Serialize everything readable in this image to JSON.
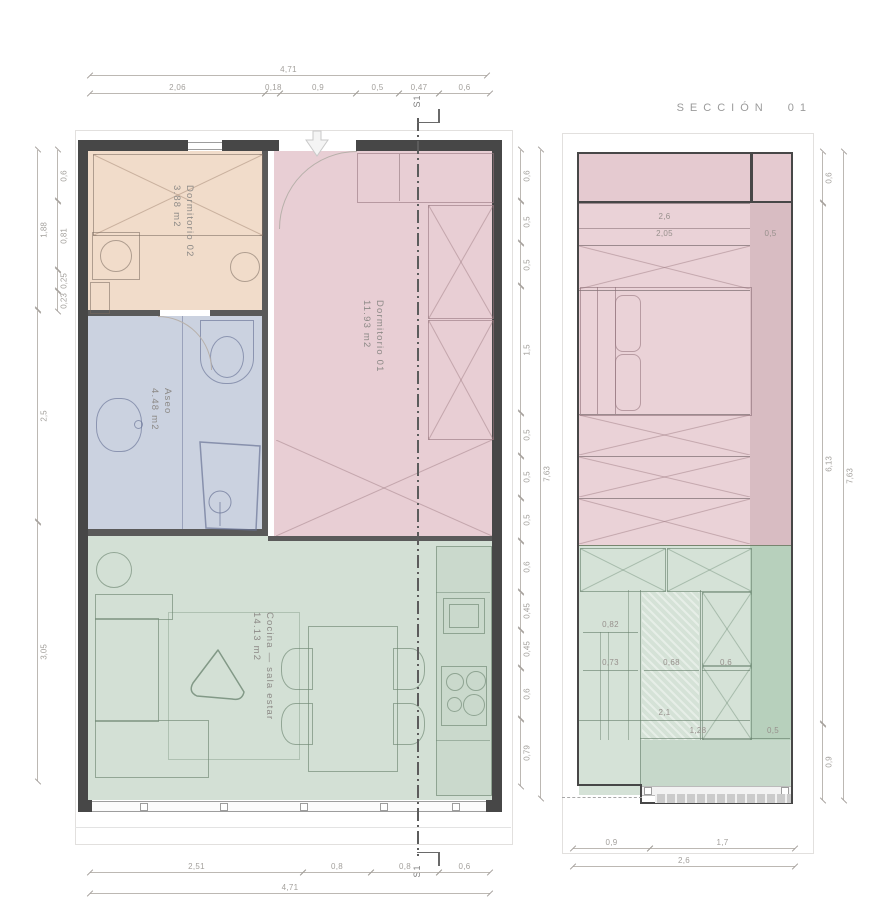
{
  "drawing": {
    "type": "architectural floor plan and section",
    "language": "Spanish"
  },
  "section_title": "SECCIÓN 01",
  "section_marker": "S1",
  "plan": {
    "rooms": [
      {
        "name": "Dormitorio 02",
        "area": "3.88 m2",
        "color": "#f1dcca"
      },
      {
        "name": "Dormitorio 01",
        "area": "11.93 m2",
        "color": "#e8ced4"
      },
      {
        "name": "Aseo",
        "area": "4.48 m2",
        "color": "#cbd2e0"
      },
      {
        "name": "Cocina — sala estar",
        "area": "14.13 m2",
        "color": "#d3e0d5"
      }
    ],
    "dims": {
      "top_total": "4,71",
      "top_chain": [
        "2,06",
        "0,18",
        "0,9",
        "0,5",
        "0,47",
        "0,6"
      ],
      "bottom_chain": [
        "2,51",
        "0,8",
        "0,8",
        "0,6"
      ],
      "bottom_total": "4,71",
      "left_inner": [
        "0,6",
        "0,81",
        "0,25",
        "0,23"
      ],
      "left_outer": [
        "1,88",
        "2,5",
        "3,05"
      ],
      "right_chain": [
        "0,6",
        "0,5",
        "0,5",
        "1,5",
        "0,5",
        "0,5",
        "0,5",
        "0,6",
        "0,45",
        "0,45",
        "0,6",
        "0,79"
      ],
      "right_total": "7,63"
    }
  },
  "section": {
    "dims": {
      "right_chain": [
        "0,6",
        "6,13",
        "0,9"
      ],
      "right_total": "7,63",
      "bottom_chain": [
        "0,9",
        "1,7"
      ],
      "bottom_total": "2,6",
      "internal": [
        "2,6",
        "2,05",
        "0,5",
        "0,82",
        "0,73",
        "0,68",
        "0,6",
        "2,1",
        "1,28",
        "0,5"
      ]
    },
    "colors": {
      "upper_fill": "#ead2d7",
      "upper_strip": "#d8bcc2",
      "lower_fill": "#d5e2d7",
      "lower_strip": "#b7d0bc"
    }
  },
  "colors": {
    "wall": "#474747",
    "dimension_line": "#bcb8b3",
    "label_text": "#8d8a87"
  }
}
